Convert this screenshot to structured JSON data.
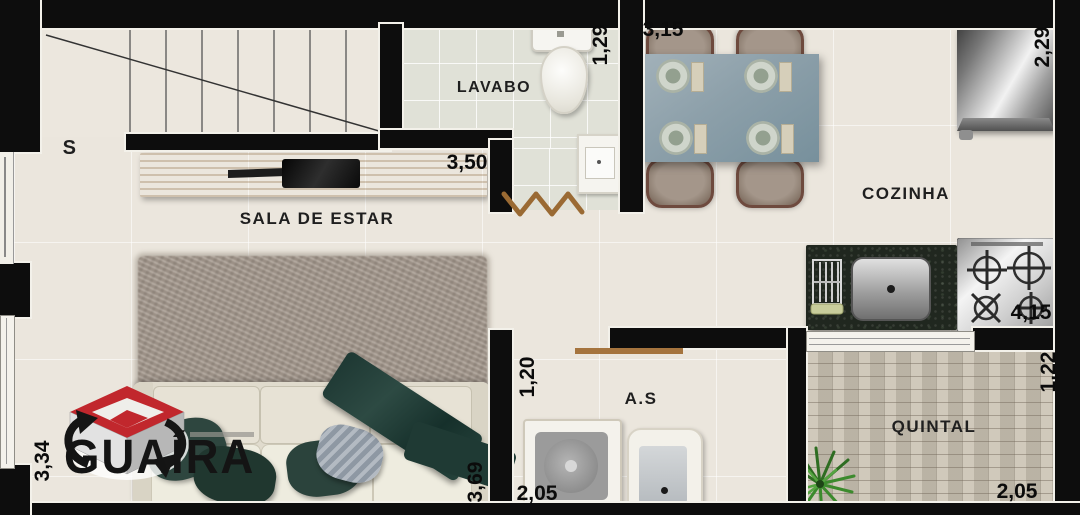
{
  "branding": {
    "company": "GUAÍRA"
  },
  "rooms": {
    "sala_de_estar": {
      "label": "SALA DE ESTAR"
    },
    "lavabo": {
      "label": "LAVABO"
    },
    "cozinha": {
      "label": "COZINHA"
    },
    "area_servico": {
      "label": "A.S"
    },
    "quintal": {
      "label": "QUINTAL"
    }
  },
  "stairs": {
    "label": "S"
  },
  "dimensions_m": {
    "sala_width": "3,50",
    "sala_depth_right": "3,69",
    "sala_depth_left": "3,34",
    "lavabo_depth": "1,29",
    "dining_width": "3,15",
    "cozinha_depth": "2,29",
    "cozinha_length": "4,15",
    "area_servico_depth": "1,20",
    "area_servico_width": "2,05",
    "quintal_depth": "1,22",
    "quintal_width": "2,05"
  },
  "furniture": [
    "staircase",
    "tv-sideboard",
    "tv",
    "soundbar",
    "rug",
    "sofa",
    "pillows",
    "throw-blanket",
    "toilet",
    "washbasin",
    "accordion-door",
    "dining-table",
    "dining-chairs",
    "place-settings",
    "refrigerator",
    "granite-counter",
    "dish-rack",
    "kitchen-sink",
    "cooktop",
    "laundry-shelf",
    "washing-machine",
    "laundry-tank",
    "plant"
  ],
  "colors": {
    "wall": "#0d0d0d",
    "floor_main": "#ebe6dd",
    "floor_lavabo": "#e0e1d7",
    "floor_quintal": "#d0c9bb",
    "wood": "#c49a5e",
    "counter_granite": "#20271f",
    "table_top": "#8da0aa",
    "sofa_fabric": "#e4dfd2",
    "pillow_teal": "#2c433d",
    "logo_red": "#c1272d"
  }
}
